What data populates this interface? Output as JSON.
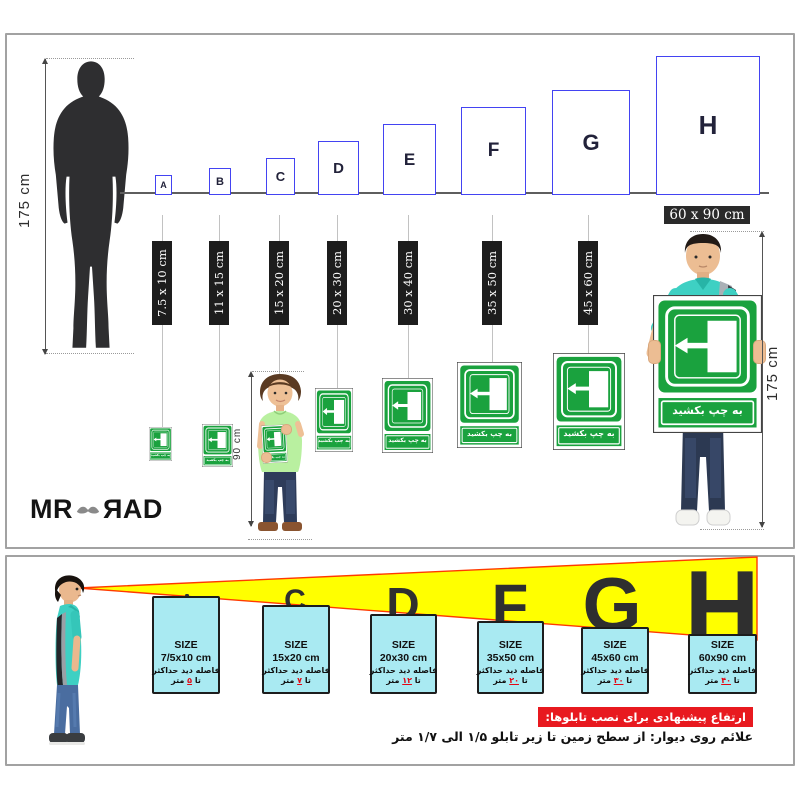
{
  "top_panel": {
    "height_ruler_label": "175 cm",
    "child_height_label": "90 cm",
    "man_height_label": "175 cm",
    "sign_text": "به چپ بکشید",
    "ground_items": [
      {
        "letter": "A",
        "size_label": "7.5 x 10 cm"
      },
      {
        "letter": "B",
        "size_label": "11 x 15 cm"
      },
      {
        "letter": "C",
        "size_label": "15 x 20 cm"
      },
      {
        "letter": "D",
        "size_label": "20 x 30 cm"
      },
      {
        "letter": "E",
        "size_label": "30 x 40 cm"
      },
      {
        "letter": "F",
        "size_label": "35 x 50 cm"
      },
      {
        "letter": "G",
        "size_label": "45 x 60 cm"
      },
      {
        "letter": "H",
        "size_label": "60 x 90 cm"
      }
    ],
    "logo": {
      "left": "MR",
      "right": "ЯAD"
    }
  },
  "bottom_panel": {
    "cards": [
      {
        "letter": "A",
        "size_title": "SIZE",
        "size_value": "7/5x10 cm",
        "distance_label": "فاصله دید حداکثر",
        "ta": "تا",
        "distance_value": "۵",
        "meter": "متر"
      },
      {
        "letter": "C",
        "size_title": "SIZE",
        "size_value": "15x20 cm",
        "distance_label": "فاصله دید حداکثر",
        "ta": "تا",
        "distance_value": "۷",
        "meter": "متر"
      },
      {
        "letter": "D",
        "size_title": "SIZE",
        "size_value": "20x30 cm",
        "distance_label": "فاصله دید حداکثر",
        "ta": "تا",
        "distance_value": "۱۲",
        "meter": "متر"
      },
      {
        "letter": "F",
        "size_title": "SIZE",
        "size_value": "35x50 cm",
        "distance_label": "فاصله دید حداکثر",
        "ta": "تا",
        "distance_value": "۲۰",
        "meter": "متر"
      },
      {
        "letter": "G",
        "size_title": "SIZE",
        "size_value": "45x60 cm",
        "distance_label": "فاصله دید حداکثر",
        "ta": "تا",
        "distance_value": "۳۰",
        "meter": "متر"
      },
      {
        "letter": "H",
        "size_title": "SIZE",
        "size_value": "60x90 cm",
        "distance_label": "فاصله دید حداکثر",
        "ta": "تا",
        "distance_value": "۴۰",
        "meter": "متر"
      }
    ],
    "recommendation_title": "ارتفاع پیشنهادی برای نصب تابلوها:",
    "recommendation_text": "علائم روی دیوار: از سطح زمین تا زیر تابلو ۱/۵ الی ۱/۷ متر"
  },
  "colors": {
    "sign_green": "#1aa23e",
    "box_blue": "#4343f2",
    "cone_yellow": "#ffff00",
    "cone_edge": "#ff3a00",
    "card_cyan": "#a9eaf2",
    "banner_red": "#e8191f",
    "digit_red": "#e30613",
    "shirt_teal": "#3ed0c3"
  }
}
